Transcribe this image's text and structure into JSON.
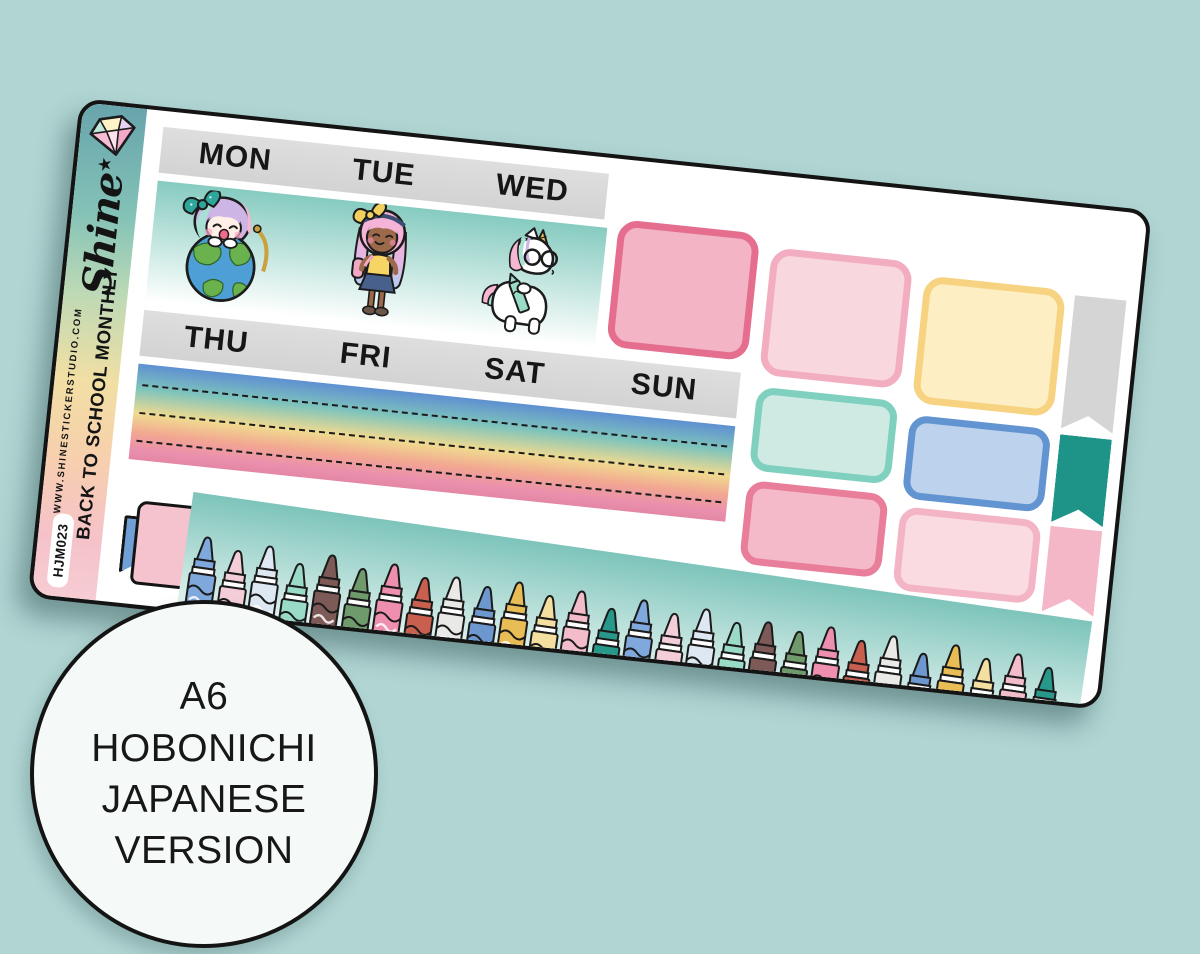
{
  "branding": {
    "logo": "Shine",
    "logo_star": "★",
    "title": "BACK TO SCHOOL MONTHLY",
    "website": "WWW.SHINESTICKERSTUDIO.COM",
    "sku": "HJM023"
  },
  "calendar": {
    "week1_days": [
      "MON",
      "TUE",
      "WED"
    ],
    "week2_days": [
      "THU",
      "FRI",
      "SAT",
      "SUN"
    ]
  },
  "characters": [
    {
      "name": "globe-girl",
      "description": "girl with pastel hair and teal bow hugging an earth globe"
    },
    {
      "name": "school-girl",
      "description": "girl with pink hair, yellow bow, yellow top, blue skirt and pink backpack"
    },
    {
      "name": "unicorn-student",
      "description": "white unicorn with round glasses holding a mint crayon"
    }
  ],
  "stickers": {
    "full_boxes": [
      {
        "name": "rose",
        "fill": "#f3b4c5",
        "border": "#e56e8f"
      },
      {
        "name": "light-pink",
        "fill": "#f9d7df",
        "border": "#f2aec0"
      },
      {
        "name": "yellow",
        "fill": "#fdeec3",
        "border": "#f7d381"
      }
    ],
    "half_boxes": [
      {
        "name": "mint",
        "fill": "#cfeae3",
        "border": "#7fd0bf"
      },
      {
        "name": "blue",
        "fill": "#bdd2ec",
        "border": "#6294d2"
      },
      {
        "name": "pink",
        "fill": "#f4bac9",
        "border": "#e87e9a"
      },
      {
        "name": "pale-pink",
        "fill": "#fadbe2",
        "border": "#f3b5c5"
      }
    ],
    "flags": [
      {
        "name": "gray",
        "color": "#d5d5d5"
      },
      {
        "name": "teal",
        "color": "#1e9488"
      },
      {
        "name": "pink",
        "color": "#f4b7c8"
      }
    ],
    "note": {
      "fill": "#f5c3ce",
      "tab_color": "#6f9fd4"
    },
    "crayon_count": 28,
    "crayon_colors": [
      "#7fa8dc",
      "#f3cdd8",
      "#dde8f2",
      "#9adbc8",
      "#7d5a57",
      "#6e9a6c",
      "#ef8fb0",
      "#c9604f",
      "#e9e9e7",
      "#6d97cf",
      "#e9bd55",
      "#f3dfa0",
      "#f2bccb",
      "#27988a"
    ]
  },
  "badge": {
    "lines": [
      "A6",
      "HOBONICHI",
      "JAPANESE",
      "VERSION"
    ]
  },
  "colors": {
    "background": "#b0d5d3",
    "strip_gray": "#d9d9d9",
    "brand_gradient": [
      "#68a4ac 0%",
      "#83c2b7 22%",
      "#bcd9b6 38%",
      "#f2dfa3 56%",
      "#f7cfae 72%",
      "#f5c2ca 88%",
      "#f7ccd3 100%"
    ],
    "rainbow_gradient": [
      "#5e90d1 0%",
      "#7fc4bc 26%",
      "#f0da90 52%",
      "#f2a791 72%",
      "#ea8fae 90%",
      "#e387a4 100%"
    ],
    "character_strip_gradient": [
      "#86cbc0 0%",
      "#fefffe 100%"
    ],
    "crayon_strip_gradient": [
      "#7dc4ba 0%",
      "#e6f4f1 100%"
    ]
  }
}
